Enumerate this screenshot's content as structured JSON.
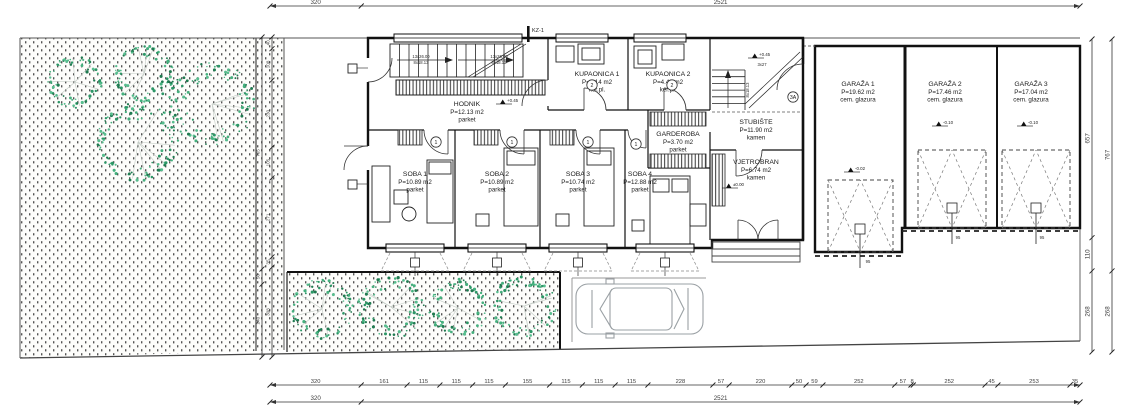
{
  "plan_title": "Ground floor plan",
  "rooms": [
    {
      "id": "hodnik",
      "name": "HODNIK",
      "area": "P=12.13 m2",
      "floor": "parket",
      "x": 467,
      "y": 100
    },
    {
      "id": "kupaonica-1",
      "name": "KUPAONICA 1",
      "area": "P=4.14 m2",
      "floor": "ker.pl.",
      "x": 597,
      "y": 70
    },
    {
      "id": "kupaonica-2",
      "name": "KUPAONICA 2",
      "area": "P=4.40 m2",
      "floor": "ker.pl.",
      "x": 668,
      "y": 70
    },
    {
      "id": "garderoba",
      "name": "GARDEROBA",
      "area": "P=3.70 m2",
      "floor": "parket",
      "x": 678,
      "y": 130
    },
    {
      "id": "stubiste",
      "name": "STUBIŠTE",
      "area": "P=11.90 m2",
      "floor": "kamen",
      "x": 756,
      "y": 118
    },
    {
      "id": "vjetrobran",
      "name": "VJETROBRAN",
      "area": "P=6.74 m2",
      "floor": "kamen",
      "x": 756,
      "y": 158
    },
    {
      "id": "soba-1",
      "name": "SOBA 1",
      "area": "P=10.89 m2",
      "floor": "parket",
      "x": 415,
      "y": 170
    },
    {
      "id": "soba-2",
      "name": "SOBA 2",
      "area": "P=10.89 m2",
      "floor": "parket",
      "x": 497,
      "y": 170
    },
    {
      "id": "soba-3",
      "name": "SOBA 3",
      "area": "P=10.74 m2",
      "floor": "parket",
      "x": 578,
      "y": 170
    },
    {
      "id": "soba-4",
      "name": "SOBA 4",
      "area": "P=12.88 m2",
      "floor": "parket",
      "x": 640,
      "y": 170
    },
    {
      "id": "garaza-1",
      "name": "GARAŽA 1",
      "area": "P=19.62 m2",
      "floor": "cem. glazura",
      "x": 858,
      "y": 80
    },
    {
      "id": "garaza-2",
      "name": "GARAŽA 2",
      "area": "P=17.46 m2",
      "floor": "cem. glazura",
      "x": 945,
      "y": 80
    },
    {
      "id": "garaza-3",
      "name": "GARAŽA 3",
      "area": "P=17.04 m2",
      "floor": "cem. glazura",
      "x": 1031,
      "y": 80
    }
  ],
  "dimensions": {
    "top": {
      "values": [
        "320",
        "2521"
      ]
    },
    "bottom_upper": {
      "values": [
        "320",
        "161",
        "115",
        "115",
        "115",
        "155",
        "115",
        "115",
        "115",
        "228",
        "57",
        "220",
        "50",
        "59",
        "252",
        "57",
        "8",
        "252",
        "45",
        "253",
        "35"
      ]
    },
    "bottom_lower": {
      "values": [
        "320",
        "2521"
      ]
    },
    "right_inner": {
      "values": [
        "657",
        "110",
        "268"
      ]
    },
    "right_outer": {
      "values": [
        "767",
        "268"
      ]
    },
    "left_outer": {
      "values": [
        "765",
        "50",
        "240"
      ]
    },
    "left_inner": {
      "values": [
        "40",
        "108",
        "230",
        "105",
        "271",
        "35",
        "308"
      ]
    }
  },
  "markers": {
    "kz": "KZ-1",
    "bubbles": [
      {
        "label": "1",
        "x": 436,
        "y": 142
      },
      {
        "label": "1",
        "x": 512,
        "y": 142
      },
      {
        "label": "1",
        "x": 588,
        "y": 142
      },
      {
        "label": "1",
        "x": 636,
        "y": 144
      },
      {
        "label": "2",
        "x": 592,
        "y": 85
      },
      {
        "label": "2",
        "x": 672,
        "y": 85
      },
      {
        "label": "3A",
        "x": 793,
        "y": 97
      }
    ],
    "levels": [
      {
        "label": "+0.45",
        "x": 500,
        "y": 104
      },
      {
        "label": "+0.45",
        "x": 752,
        "y": 58
      },
      {
        "label": "±0.00",
        "x": 726,
        "y": 188
      },
      {
        "label": "-0.02",
        "x": 848,
        "y": 172
      },
      {
        "label": "-0.10",
        "x": 936,
        "y": 126
      },
      {
        "label": "-0.10",
        "x": 1021,
        "y": 126
      }
    ]
  },
  "annotations": [
    {
      "text": "13x26.00",
      "x": 421,
      "y": 58,
      "rot": 0
    },
    {
      "text": "8x18.13",
      "x": 421,
      "y": 64,
      "rot": 0
    },
    {
      "text": "13x26.00",
      "x": 499,
      "y": 58,
      "rot": 0
    },
    {
      "text": "8x18.13",
      "x": 499,
      "y": 64,
      "rot": 0
    },
    {
      "text": "3x27",
      "x": 762,
      "y": 66,
      "rot": 0
    },
    {
      "text": "8x18.13",
      "x": 749,
      "y": 90,
      "rot": -90
    },
    {
      "text": "95",
      "x": 868,
      "y": 263,
      "rot": 0
    },
    {
      "text": "95",
      "x": 958,
      "y": 239,
      "rot": 0
    },
    {
      "text": "95",
      "x": 1042,
      "y": 239,
      "rot": 0
    }
  ],
  "colors": {
    "tree_greens": [
      "#2c9666",
      "#45b07e",
      "#1f7a50",
      "#57bd8e"
    ],
    "line": "#1b1b1b",
    "dim": "#3d3d3d",
    "car": "#9aa0a4"
  },
  "trees": [
    {
      "cx": 75,
      "cy": 82,
      "r": 27
    },
    {
      "cx": 144,
      "cy": 74,
      "r": 30
    },
    {
      "cx": 138,
      "cy": 142,
      "r": 41
    },
    {
      "cx": 212,
      "cy": 104,
      "r": 43
    },
    {
      "cx": 322,
      "cy": 309,
      "r": 31
    },
    {
      "cx": 391,
      "cy": 307,
      "r": 33
    },
    {
      "cx": 458,
      "cy": 308,
      "r": 30
    },
    {
      "cx": 524,
      "cy": 306,
      "r": 32
    }
  ]
}
